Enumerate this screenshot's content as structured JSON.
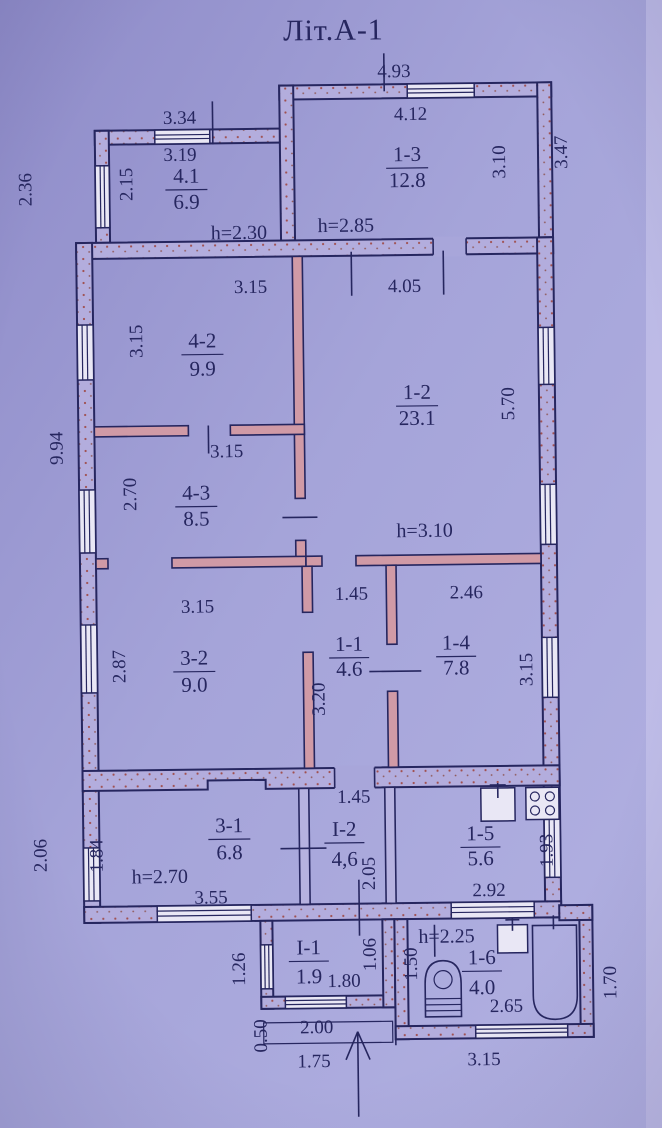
{
  "title": "Літ.А-1",
  "colors": {
    "paper": "#a2a1d6",
    "ink": "#26265f",
    "partition_pink": "#d09aa6",
    "stipple_dot": "#a05050",
    "window_fill": "#e9e7f5"
  },
  "rooms": [
    {
      "code": "4.1",
      "area": "6.9"
    },
    {
      "code": "1-3",
      "area": "12.8"
    },
    {
      "code": "4-2",
      "area": "9.9"
    },
    {
      "code": "1-2",
      "area": "23.1"
    },
    {
      "code": "4-3",
      "area": "8.5"
    },
    {
      "code": "3-2",
      "area": "9.0"
    },
    {
      "code": "1-1",
      "area": "4.6"
    },
    {
      "code": "1-4",
      "area": "7.8"
    },
    {
      "code": "3-1",
      "area": "6.8"
    },
    {
      "code": "I-2",
      "area": "4,6"
    },
    {
      "code": "1-5",
      "area": "5.6"
    },
    {
      "code": "I-1",
      "area": "1.9"
    },
    {
      "code": "1-6",
      "area": "4.0"
    }
  ],
  "heights": {
    "h1": "h=2.30",
    "h2": "h=2.85",
    "h3": "h=3.10",
    "h4": "h=2.70",
    "h5": "h=2.25"
  },
  "dims": {
    "top493": "4.93",
    "t334": "3.34",
    "t319": "3.19",
    "t412": "4.12",
    "w315a": "3.15",
    "w405": "4.05",
    "w315b": "3.15",
    "w315c": "3.15",
    "c145a": "1.45",
    "c246": "2.46",
    "c145b": "1.45",
    "b355": "3.55",
    "b292": "2.92",
    "b180": "1.80",
    "b200": "2.00",
    "b175": "1.75",
    "b315": "3.15",
    "b265": "2.65",
    "l236": "2.36",
    "l215": "2.15",
    "r310": "3.10",
    "r347": "3.47",
    "l315": "3.15",
    "r570": "5.70",
    "l994": "9.94",
    "l270": "2.70",
    "l287": "2.87",
    "c320": "3.20",
    "r315": "3.15",
    "l206": "2.06",
    "l184": "1.84",
    "c205": "2.05",
    "r193": "1.93",
    "l126": "1.26",
    "c106": "1.06",
    "l050": "0.50",
    "c150": "1.50",
    "r170": "1.70"
  },
  "icons": {
    "kitchen_sink": "sink-icon",
    "stove": "stove-icon",
    "wash_sink": "sink-icon",
    "toilet": "toilet-icon",
    "bathtub": "bathtub-icon",
    "entrance": "arrow-up-icon"
  }
}
